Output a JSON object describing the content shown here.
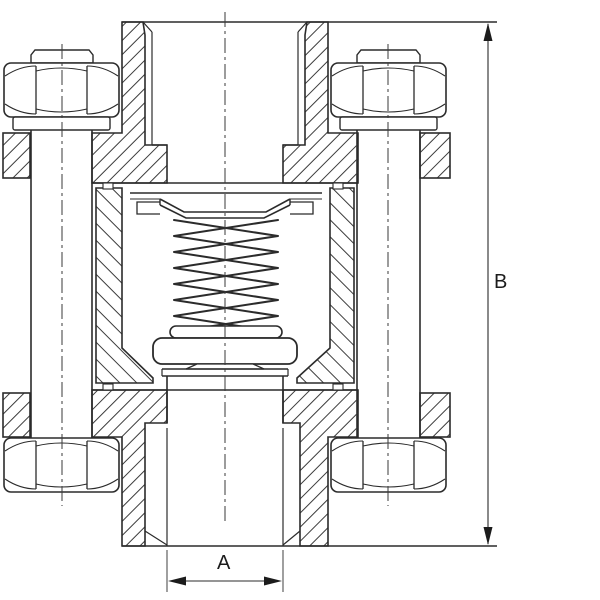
{
  "drawing": {
    "description": "Cross-section of a spring-loaded inline check valve with bolted flanges and threaded ports",
    "dimensions": {
      "a_label": "A",
      "b_label": "B"
    },
    "colors": {
      "line": "#2b2b2b",
      "hatch": "#3c3c3c",
      "background": "#ffffff"
    }
  }
}
